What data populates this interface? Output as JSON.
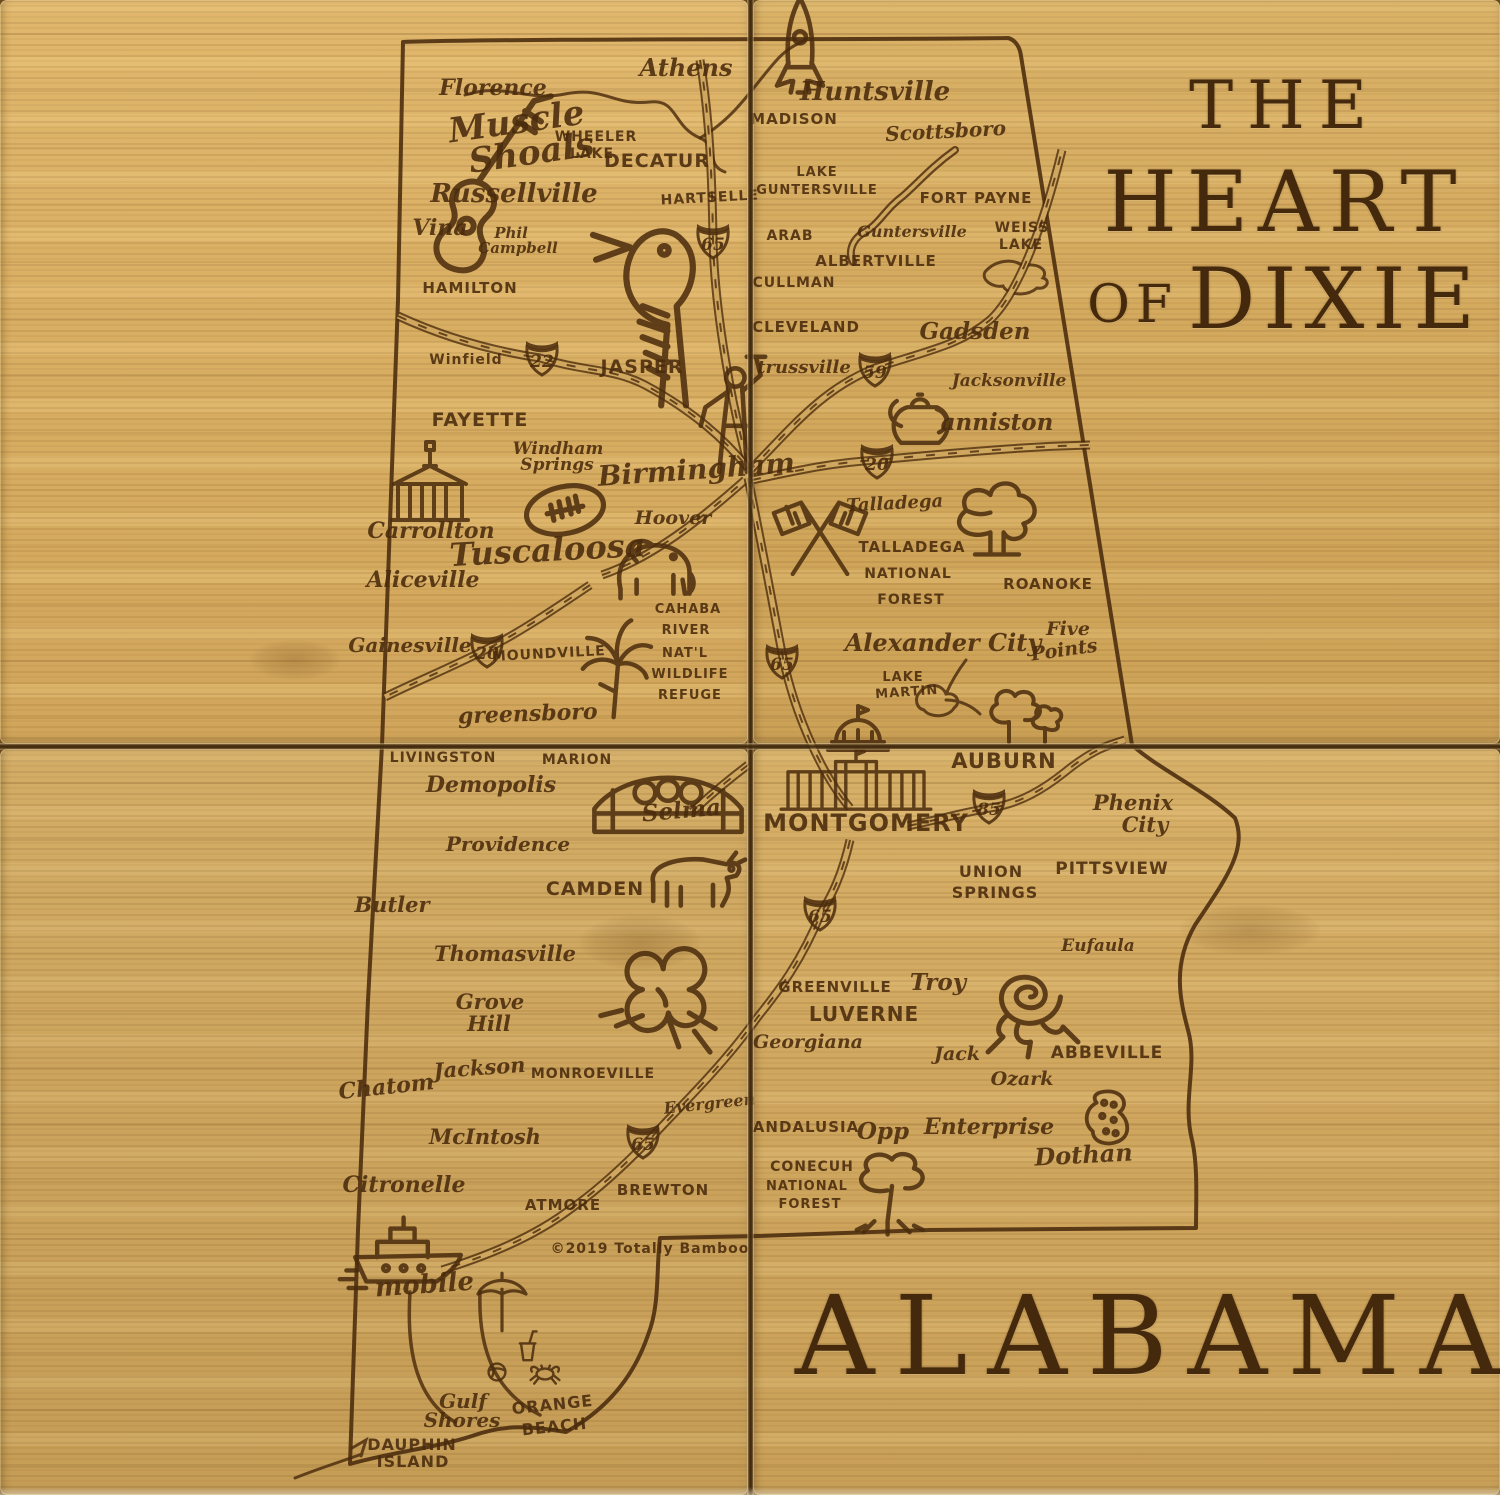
{
  "titles": {
    "the": "THE",
    "heart": "HEART",
    "of": "OF",
    "dixie": "DIXIE",
    "state_name": "ALABAMA",
    "copyright": "©2019 Totally Bamboo"
  },
  "colors": {
    "bamboo": "#d0a75f",
    "engrave": "#4a2b0c",
    "seam": "#3e270c"
  },
  "map": {
    "outline": "M403,42 C530,38 880,40 1008,38 C1016,40 1020,48 1021,56 L1132,745 C1160,770 1205,790 1235,818 C1248,850 1225,880 1195,925 C1172,965 1180,1000 1188,1030 C1198,1065 1182,1100 1192,1140 C1198,1165 1196,1200 1196,1228 L930,1230 L758,1236 L660,1238 C656,1270 660,1305 648,1335 C632,1382 602,1412 566,1432 C530,1426 505,1424 472,1436 C435,1448 392,1452 350,1464 L358,1230 L368,1000 L382,745 L398,300 Z",
    "rivers": [
      {
        "name": "tennessee-river",
        "w": 3,
        "d": "M465,95 C505,82 525,102 565,94 C605,86 612,106 650,102 C678,99 672,126 700,138 C720,147 705,165 725,172"
      },
      {
        "name": "tennessee-river-ne",
        "w": 3,
        "d": "M700,138 C735,118 752,88 775,62 C785,50 795,45 805,40"
      },
      {
        "name": "lake-guntersville",
        "w": 8,
        "d": "M955,150 C930,168 918,183 903,196 C884,210 880,224 863,233 C852,240 848,252 853,262"
      },
      {
        "name": "lake-guntersville-inner",
        "w": 3.5,
        "d": "M955,150 C930,168 918,183 903,196 C884,210 880,224 863,233 C852,240 848,252 853,262",
        "light": true
      },
      {
        "name": "weiss-lake",
        "w": 3,
        "d": "M985,272 C995,260 1013,258 1023,266 C1037,262 1049,270 1043,278 C1051,280 1047,290 1037,288 C1025,298 1007,294 1003,286 C993,288 981,280 985,272 Z"
      },
      {
        "name": "lake-martin",
        "w": 3,
        "d": "M920,692 C928,682 942,684 946,694 C956,692 962,702 954,708 C948,718 930,718 924,710 C916,708 914,698 920,692 Z M946,694 C952,680 960,668 966,660 M946,700 C960,700 972,706 980,714"
      },
      {
        "name": "mobile-bay-west",
        "w": 3.5,
        "d": "M410,1292 C406,1355 418,1400 455,1422"
      },
      {
        "name": "mobile-bay-east",
        "w": 3.5,
        "d": "M480,1292 C478,1350 495,1392 540,1415"
      },
      {
        "name": "dauphin-spit",
        "w": 3,
        "d": "M295,1478 C320,1468 340,1462 362,1454 M352,1448 l14,-8 l-5,16"
      }
    ],
    "roads": [
      {
        "name": "i65-north",
        "d": "M700,60 C710,120 712,180 713,238 C714,300 728,390 748,465"
      },
      {
        "name": "us78-i22",
        "d": "M398,316 C450,340 500,352 540,358 C585,372 612,368 645,385 C695,412 725,440 748,468"
      },
      {
        "name": "i59",
        "d": "M748,472 C790,430 820,390 875,368 C930,350 960,345 990,320 C1014,298 1040,240 1062,150"
      },
      {
        "name": "i20",
        "d": "M752,480 C800,470 830,463 877,460 C930,455 1010,448 1060,446 L1090,445"
      },
      {
        "name": "us82",
        "d": "M590,585 C550,612 520,632 487,649 C450,668 415,682 385,697"
      },
      {
        "name": "tuscaloosa-birmingham",
        "d": "M602,575 C652,558 700,520 745,480"
      },
      {
        "name": "i65-mid",
        "d": "M748,478 C762,545 772,602 783,658 C795,715 822,775 850,808"
      },
      {
        "name": "i65-south",
        "d": "M850,840 C842,875 832,895 821,913 C800,965 775,995 757,1018 C728,1058 695,1092 666,1122 C640,1150 605,1185 572,1208 C530,1240 480,1258 442,1270"
      },
      {
        "name": "i85",
        "d": "M908,826 C945,818 965,812 990,808 C1020,804 1045,788 1065,772 C1092,750 1108,745 1125,740"
      },
      {
        "name": "selma-road",
        "d": "M748,765 C715,790 702,803 692,812"
      }
    ],
    "shields": [
      {
        "num": "65",
        "x": 713,
        "y": 240
      },
      {
        "num": "22",
        "x": 542,
        "y": 357
      },
      {
        "num": "20",
        "x": 487,
        "y": 649
      },
      {
        "num": "59",
        "x": 875,
        "y": 368
      },
      {
        "num": "20",
        "x": 877,
        "y": 460
      },
      {
        "num": "65",
        "x": 782,
        "y": 660
      },
      {
        "num": "85",
        "x": 989,
        "y": 805
      },
      {
        "num": "65",
        "x": 820,
        "y": 912
      },
      {
        "num": "65",
        "x": 643,
        "y": 1140
      }
    ],
    "icons": [
      {
        "n": "guitar-icon",
        "x": 468,
        "y": 220,
        "sc": 3.0,
        "r": 15
      },
      {
        "n": "woodpecker-icon",
        "x": 655,
        "y": 300,
        "sc": 3.1
      },
      {
        "n": "vulcan-statue-icon",
        "x": 733,
        "y": 412,
        "sc": 2.3
      },
      {
        "n": "courthouse-icon",
        "x": 430,
        "y": 492,
        "sc": 2.0
      },
      {
        "n": "football-icon",
        "x": 565,
        "y": 510,
        "sc": 2.6
      },
      {
        "n": "elephant-icon",
        "x": 655,
        "y": 566,
        "sc": 2.3
      },
      {
        "n": "lily-icon",
        "x": 618,
        "y": 660,
        "sc": 2.2
      },
      {
        "n": "rocket-icon",
        "x": 800,
        "y": 58,
        "sc": 2.3
      },
      {
        "n": "teapot-icon",
        "x": 920,
        "y": 424,
        "sc": 2.1
      },
      {
        "n": "racing-flags-icon",
        "x": 820,
        "y": 532,
        "sc": 2.1
      },
      {
        "n": "oak-tree-icon",
        "x": 997,
        "y": 528,
        "sc": 2.2
      },
      {
        "n": "capitol-dome-icon",
        "x": 858,
        "y": 722,
        "sc": 2.0
      },
      {
        "n": "trees-icon",
        "x": 1025,
        "y": 714,
        "sc": 2.0
      },
      {
        "n": "capitol-building-icon",
        "x": 856,
        "y": 782,
        "sc": 1.7
      },
      {
        "n": "bridge-icon",
        "x": 668,
        "y": 795,
        "sc": 2.3
      },
      {
        "n": "cow-icon",
        "x": 690,
        "y": 878,
        "sc": 2.3
      },
      {
        "n": "cotton-icon",
        "x": 658,
        "y": 1000,
        "sc": 2.6
      },
      {
        "n": "rose-icon",
        "x": 1028,
        "y": 1002,
        "sc": 2.5
      },
      {
        "n": "peanut-icon",
        "x": 1108,
        "y": 1118,
        "sc": 1.9
      },
      {
        "n": "pine-tree-icon",
        "x": 892,
        "y": 1186,
        "sc": 2.2
      },
      {
        "n": "ship-icon",
        "x": 408,
        "y": 1244,
        "sc": 2.2
      },
      {
        "n": "umbrella-icon",
        "x": 502,
        "y": 1302,
        "sc": 1.6
      },
      {
        "n": "drink-icon",
        "x": 527,
        "y": 1347,
        "sc": 1.2
      },
      {
        "n": "crab-icon",
        "x": 545,
        "y": 1374,
        "sc": 1.2
      },
      {
        "n": "beach-ball-icon",
        "x": 497,
        "y": 1372,
        "sc": 1.2
      }
    ],
    "labels": [
      {
        "t": "Florence",
        "x": 493,
        "y": 95,
        "s": 22,
        "c": "s"
      },
      {
        "t": "Muscle",
        "x": 518,
        "y": 133,
        "s": 34,
        "c": "s",
        "r": -8
      },
      {
        "t": "Shoals",
        "x": 533,
        "y": 164,
        "s": 34,
        "c": "s",
        "r": -8
      },
      {
        "t": "WHEELER",
        "x": 596,
        "y": 141,
        "s": 14,
        "c": "c"
      },
      {
        "t": "LAKE",
        "x": 592,
        "y": 158,
        "s": 14,
        "c": "c"
      },
      {
        "t": "DECATUR",
        "x": 657,
        "y": 167,
        "s": 19,
        "c": "c"
      },
      {
        "t": "Athens",
        "x": 686,
        "y": 76,
        "s": 24,
        "c": "sb"
      },
      {
        "t": "Russellville",
        "x": 514,
        "y": 202,
        "s": 26,
        "c": "s"
      },
      {
        "t": "Vina",
        "x": 440,
        "y": 235,
        "s": 22,
        "c": "s"
      },
      {
        "t": "Phil",
        "x": 511,
        "y": 238,
        "s": 15,
        "c": "s"
      },
      {
        "t": "Campbell",
        "x": 518,
        "y": 253,
        "s": 15,
        "c": "s"
      },
      {
        "t": "HARTSELLE",
        "x": 710,
        "y": 202,
        "s": 14,
        "c": "c",
        "r": -3
      },
      {
        "t": "HAMILTON",
        "x": 470,
        "y": 293,
        "s": 15,
        "c": "c"
      },
      {
        "t": "Winfield",
        "x": 466,
        "y": 364,
        "s": 14,
        "c": "c"
      },
      {
        "t": "JASPER",
        "x": 642,
        "y": 373,
        "s": 19,
        "c": "c"
      },
      {
        "t": "FAYETTE",
        "x": 480,
        "y": 426,
        "s": 19,
        "c": "c"
      },
      {
        "t": "Windham",
        "x": 558,
        "y": 454,
        "s": 17,
        "c": "s"
      },
      {
        "t": "Springs",
        "x": 557,
        "y": 470,
        "s": 17,
        "c": "s"
      },
      {
        "t": "Birmingham",
        "x": 697,
        "y": 479,
        "s": 28,
        "c": "s",
        "r": -4
      },
      {
        "t": "Carrollton",
        "x": 431,
        "y": 538,
        "s": 22,
        "c": "s"
      },
      {
        "t": "Tuscaloosa",
        "x": 548,
        "y": 561,
        "s": 32,
        "c": "s",
        "r": -3
      },
      {
        "t": "Hoover",
        "x": 673,
        "y": 524,
        "s": 19,
        "c": "s"
      },
      {
        "t": "Aliceville",
        "x": 423,
        "y": 587,
        "s": 22,
        "c": "s"
      },
      {
        "t": "Gainesville",
        "x": 410,
        "y": 652,
        "s": 20,
        "c": "s"
      },
      {
        "t": "MOUNDVILLE",
        "x": 549,
        "y": 658,
        "s": 14,
        "c": "c",
        "r": -3
      },
      {
        "t": "CAHABA",
        "x": 688,
        "y": 613,
        "s": 13,
        "c": "c"
      },
      {
        "t": "RIVER",
        "x": 686,
        "y": 634,
        "s": 13,
        "c": "c"
      },
      {
        "t": "NAT'L",
        "x": 685,
        "y": 657,
        "s": 13,
        "c": "c"
      },
      {
        "t": "WILDLIFE",
        "x": 690,
        "y": 678,
        "s": 13,
        "c": "c"
      },
      {
        "t": "REFUGE",
        "x": 690,
        "y": 699,
        "s": 13,
        "c": "c"
      },
      {
        "t": "greensboro",
        "x": 528,
        "y": 721,
        "s": 22,
        "c": "s",
        "r": -2
      },
      {
        "t": "Huntsville",
        "x": 875,
        "y": 100,
        "s": 26,
        "c": "sb"
      },
      {
        "t": "MADISON",
        "x": 794,
        "y": 124,
        "s": 15,
        "c": "c"
      },
      {
        "t": "Scottsboro",
        "x": 946,
        "y": 138,
        "s": 20,
        "c": "s",
        "r": -3
      },
      {
        "t": "LAKE",
        "x": 817,
        "y": 176,
        "s": 13,
        "c": "c"
      },
      {
        "t": "GUNTERSVILLE",
        "x": 817,
        "y": 194,
        "s": 13,
        "c": "c"
      },
      {
        "t": "FORT PAYNE",
        "x": 976,
        "y": 203,
        "s": 15,
        "c": "c"
      },
      {
        "t": "ARAB",
        "x": 790,
        "y": 240,
        "s": 14,
        "c": "c"
      },
      {
        "t": "Guntersville",
        "x": 912,
        "y": 237,
        "s": 16,
        "c": "s"
      },
      {
        "t": "WEISS",
        "x": 1022,
        "y": 232,
        "s": 14,
        "c": "c"
      },
      {
        "t": "LAKE",
        "x": 1021,
        "y": 249,
        "s": 14,
        "c": "c"
      },
      {
        "t": "ALBERTVILLE",
        "x": 876,
        "y": 266,
        "s": 15,
        "c": "c"
      },
      {
        "t": "CULLMAN",
        "x": 794,
        "y": 287,
        "s": 14,
        "c": "c"
      },
      {
        "t": "CLEVELAND",
        "x": 806,
        "y": 332,
        "s": 15,
        "c": "c"
      },
      {
        "t": "Gadsden",
        "x": 975,
        "y": 339,
        "s": 23,
        "c": "s"
      },
      {
        "t": "trussville",
        "x": 804,
        "y": 373,
        "s": 18,
        "c": "s"
      },
      {
        "t": "Jacksonville",
        "x": 1009,
        "y": 386,
        "s": 17,
        "c": "s"
      },
      {
        "t": "anniston",
        "x": 997,
        "y": 430,
        "s": 23,
        "c": "s"
      },
      {
        "t": "Talladega",
        "x": 895,
        "y": 509,
        "s": 18,
        "c": "s",
        "r": -3
      },
      {
        "t": "TALLADEGA",
        "x": 912,
        "y": 552,
        "s": 15,
        "c": "c"
      },
      {
        "t": "NATIONAL",
        "x": 908,
        "y": 578,
        "s": 14,
        "c": "c"
      },
      {
        "t": "FOREST",
        "x": 911,
        "y": 604,
        "s": 14,
        "c": "c"
      },
      {
        "t": "ROANOKE",
        "x": 1048,
        "y": 589,
        "s": 15,
        "c": "c"
      },
      {
        "t": "Alexander City",
        "x": 943,
        "y": 651,
        "s": 24,
        "c": "s"
      },
      {
        "t": "Five",
        "x": 1068,
        "y": 635,
        "s": 19,
        "c": "s"
      },
      {
        "t": "Points",
        "x": 1065,
        "y": 656,
        "s": 19,
        "c": "s",
        "r": -8
      },
      {
        "t": "LAKE",
        "x": 903,
        "y": 681,
        "s": 13,
        "c": "c"
      },
      {
        "t": "MARTIN",
        "x": 907,
        "y": 696,
        "s": 13,
        "c": "c",
        "r": -4
      },
      {
        "t": "AUBURN",
        "x": 1004,
        "y": 768,
        "s": 21,
        "c": "c"
      },
      {
        "t": "MONTGOMERY",
        "x": 866,
        "y": 831,
        "s": 24,
        "c": "c"
      },
      {
        "t": "Phenix",
        "x": 1133,
        "y": 810,
        "s": 21,
        "c": "s"
      },
      {
        "t": "City",
        "x": 1145,
        "y": 832,
        "s": 21,
        "c": "s"
      },
      {
        "t": "UNION",
        "x": 991,
        "y": 877,
        "s": 16,
        "c": "c"
      },
      {
        "t": "SPRINGS",
        "x": 995,
        "y": 898,
        "s": 16,
        "c": "c"
      },
      {
        "t": "PITTSVIEW",
        "x": 1112,
        "y": 874,
        "s": 17,
        "c": "c"
      },
      {
        "t": "GREENVILLE",
        "x": 835,
        "y": 992,
        "s": 15,
        "c": "c"
      },
      {
        "t": "Troy",
        "x": 938,
        "y": 990,
        "s": 23,
        "c": "s"
      },
      {
        "t": "LUVERNE",
        "x": 864,
        "y": 1021,
        "s": 20,
        "c": "c"
      },
      {
        "t": "Georgiana",
        "x": 808,
        "y": 1048,
        "s": 19,
        "c": "s"
      },
      {
        "t": "Jack",
        "x": 957,
        "y": 1060,
        "s": 19,
        "c": "s"
      },
      {
        "t": "ABBEVILLE",
        "x": 1107,
        "y": 1058,
        "s": 17,
        "c": "c"
      },
      {
        "t": "Ozark",
        "x": 1022,
        "y": 1085,
        "s": 19,
        "c": "s"
      },
      {
        "t": "Eufaula",
        "x": 1098,
        "y": 951,
        "s": 17,
        "c": "s"
      },
      {
        "t": "ANDALUSIA",
        "x": 806,
        "y": 1132,
        "s": 15,
        "c": "c"
      },
      {
        "t": "Opp",
        "x": 883,
        "y": 1139,
        "s": 23,
        "c": "s"
      },
      {
        "t": "Enterprise",
        "x": 989,
        "y": 1134,
        "s": 22,
        "c": "s"
      },
      {
        "t": "Dothan",
        "x": 1084,
        "y": 1163,
        "s": 24,
        "c": "s",
        "r": -3
      },
      {
        "t": "CONECUH",
        "x": 812,
        "y": 1171,
        "s": 14,
        "c": "c"
      },
      {
        "t": "NATIONAL",
        "x": 807,
        "y": 1190,
        "s": 13,
        "c": "c"
      },
      {
        "t": "FOREST",
        "x": 810,
        "y": 1208,
        "s": 13,
        "c": "c"
      },
      {
        "t": "LIVINGSTON",
        "x": 443,
        "y": 762,
        "s": 14,
        "c": "c"
      },
      {
        "t": "MARION",
        "x": 577,
        "y": 764,
        "s": 14,
        "c": "c"
      },
      {
        "t": "Demopolis",
        "x": 491,
        "y": 792,
        "s": 22,
        "c": "s"
      },
      {
        "t": "Selma",
        "x": 682,
        "y": 818,
        "s": 23,
        "c": "s",
        "r": -5
      },
      {
        "t": "Providence",
        "x": 508,
        "y": 851,
        "s": 20,
        "c": "s"
      },
      {
        "t": "CAMDEN",
        "x": 595,
        "y": 895,
        "s": 19,
        "c": "c"
      },
      {
        "t": "Butler",
        "x": 392,
        "y": 912,
        "s": 21,
        "c": "s"
      },
      {
        "t": "Thomasville",
        "x": 505,
        "y": 961,
        "s": 21,
        "c": "s"
      },
      {
        "t": "Grove",
        "x": 490,
        "y": 1009,
        "s": 21,
        "c": "s"
      },
      {
        "t": "Hill",
        "x": 489,
        "y": 1031,
        "s": 21,
        "c": "s"
      },
      {
        "t": "Jackson",
        "x": 480,
        "y": 1075,
        "s": 21,
        "c": "s",
        "r": -4
      },
      {
        "t": "MONROEVILLE",
        "x": 593,
        "y": 1078,
        "s": 14,
        "c": "c"
      },
      {
        "t": "Chatom",
        "x": 387,
        "y": 1094,
        "s": 22,
        "c": "s",
        "r": -6
      },
      {
        "t": "Evergreen",
        "x": 710,
        "y": 1109,
        "s": 16,
        "c": "s",
        "r": -6
      },
      {
        "t": "McIntosh",
        "x": 485,
        "y": 1144,
        "s": 21,
        "c": "s"
      },
      {
        "t": "Citronelle",
        "x": 404,
        "y": 1192,
        "s": 22,
        "c": "s"
      },
      {
        "t": "ATMORE",
        "x": 563,
        "y": 1210,
        "s": 15,
        "c": "c"
      },
      {
        "t": "BREWTON",
        "x": 663,
        "y": 1195,
        "s": 15,
        "c": "c"
      },
      {
        "t": "©2019 Totally Bamboo",
        "x": 650,
        "y": 1253,
        "s": 14,
        "c": "c"
      },
      {
        "t": "mobile",
        "x": 425,
        "y": 1293,
        "s": 26,
        "c": "s",
        "r": -4
      },
      {
        "t": "Gulf",
        "x": 463,
        "y": 1408,
        "s": 20,
        "c": "s"
      },
      {
        "t": "Shores",
        "x": 462,
        "y": 1427,
        "s": 20,
        "c": "s"
      },
      {
        "t": "ORANGE",
        "x": 553,
        "y": 1410,
        "s": 16,
        "c": "c",
        "r": -6
      },
      {
        "t": "BEACH",
        "x": 555,
        "y": 1432,
        "s": 16,
        "c": "c",
        "r": -6
      },
      {
        "t": "DAUPHIN",
        "x": 412,
        "y": 1450,
        "s": 16,
        "c": "c"
      },
      {
        "t": "ISLAND",
        "x": 413,
        "y": 1467,
        "s": 16,
        "c": "c"
      }
    ]
  }
}
